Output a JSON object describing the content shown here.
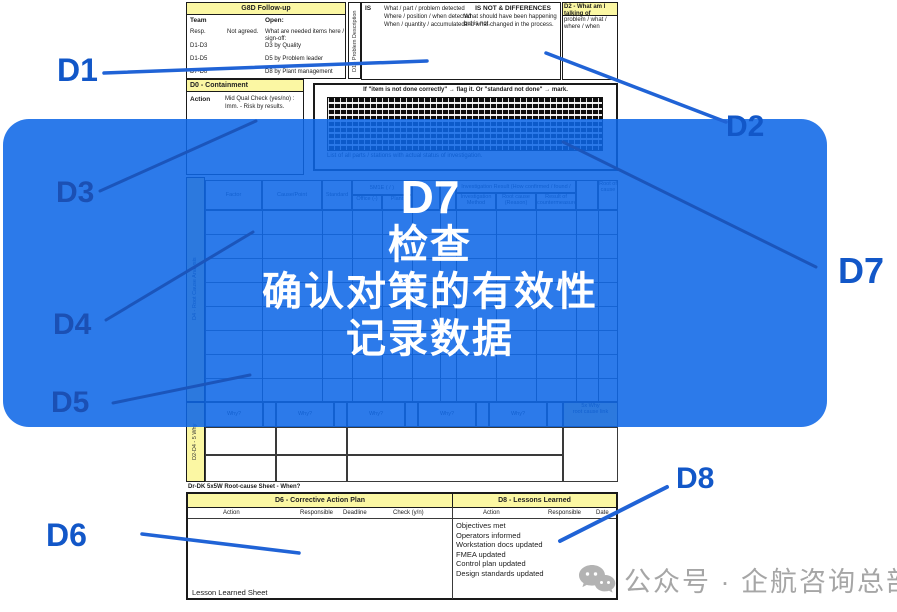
{
  "overlay": {
    "badge": "D7",
    "line1": "检查",
    "line2": "确认对策的有效性",
    "line3": "记录数据"
  },
  "labels": {
    "d1": "D1",
    "d2": "D2",
    "d3": "D3",
    "d4": "D4",
    "d5": "D5",
    "d6": "D6",
    "d7": "D7",
    "d8": "D8"
  },
  "accent_colors": {
    "label_blue": "#1257C8",
    "overlay_blue": "#1e6fe8",
    "header_yellow": "#FBF7A3"
  },
  "watermark": {
    "icon": "chat-bubbles-icon",
    "text": "公众号 · 企航咨询总部"
  },
  "form": {
    "g8d": {
      "title": "G8D Follow-up",
      "team": "Team",
      "open": "Open:",
      "r2a": "Resp.",
      "r2b": "Not agreed.",
      "r2c": "What are needed items here / sign-off:",
      "r3a": "D1-D3",
      "r3b": "D3 by Quality",
      "r4a": "D1-D5",
      "r4b": "D5 by Problem leader",
      "r5a": "D7-D8",
      "r5b": "D8 by Plant management"
    },
    "d1_strip": "D1 - Problem Description",
    "isnot": {
      "is_label": "IS",
      "l1": "What / part / problem detected",
      "l2": "Where / position / when detected",
      "l3": "When / quantity / accumulated",
      "title": "IS NOT & DIFFERENCES",
      "r1": "What should have been happening but is not,",
      "r2": "and what changed in the process."
    },
    "d2box": {
      "l1": "D2 - What am I talking of",
      "l2": "problem / what / where / when"
    },
    "d0": {
      "title": "D0 - Containment",
      "action": "Action",
      "t1": "Mid    Qual    Check (yes/no) :",
      "t2": "Imm.  -  Risk by results."
    },
    "gridbox": {
      "caption": "If \"item is not done correctly\" → flag it.   Or \"standard not done\" → mark.",
      "footer": "List of all parts / stations with actual status of investigation."
    },
    "cause_table": {
      "side_label": "D4 - Root Cause Analysis",
      "h_factor": "Factor",
      "h_cause": "Cause/Point",
      "h_std": "Standard",
      "h_5m": "5M1E ( / )",
      "h_m1": "Office (-)",
      "h_m2": "Plant",
      "group": "Investigation Result (How confirmed / found / root cause)",
      "s1": "Investigation Method",
      "s2": "Root cause (Reason)",
      "s3": "Result of countermeasure",
      "right_col": "Root of cause",
      "why": "Why?",
      "why_link1": "5x Why",
      "why_link2": "root cause link",
      "why_side": "D2-D4  -  5 Why"
    },
    "note_line": "Dr-DK 5x5W Root-cause Sheet - When?",
    "d6": {
      "title": "D6 - Corrective Action Plan",
      "h1": "Action",
      "h2": "Responsible",
      "h3": "Deadline",
      "h4": "Check (y/n)",
      "footer": "Lesson Learned Sheet"
    },
    "d8": {
      "title": "D8 - Lessons Learned",
      "h1": "Action",
      "h2": "Responsible",
      "h3": "Date",
      "items": [
        "Objectives met",
        "Operators informed",
        "Workstation docs updated",
        "FMEA updated",
        "Control plan updated",
        "Design standards updated"
      ]
    }
  }
}
